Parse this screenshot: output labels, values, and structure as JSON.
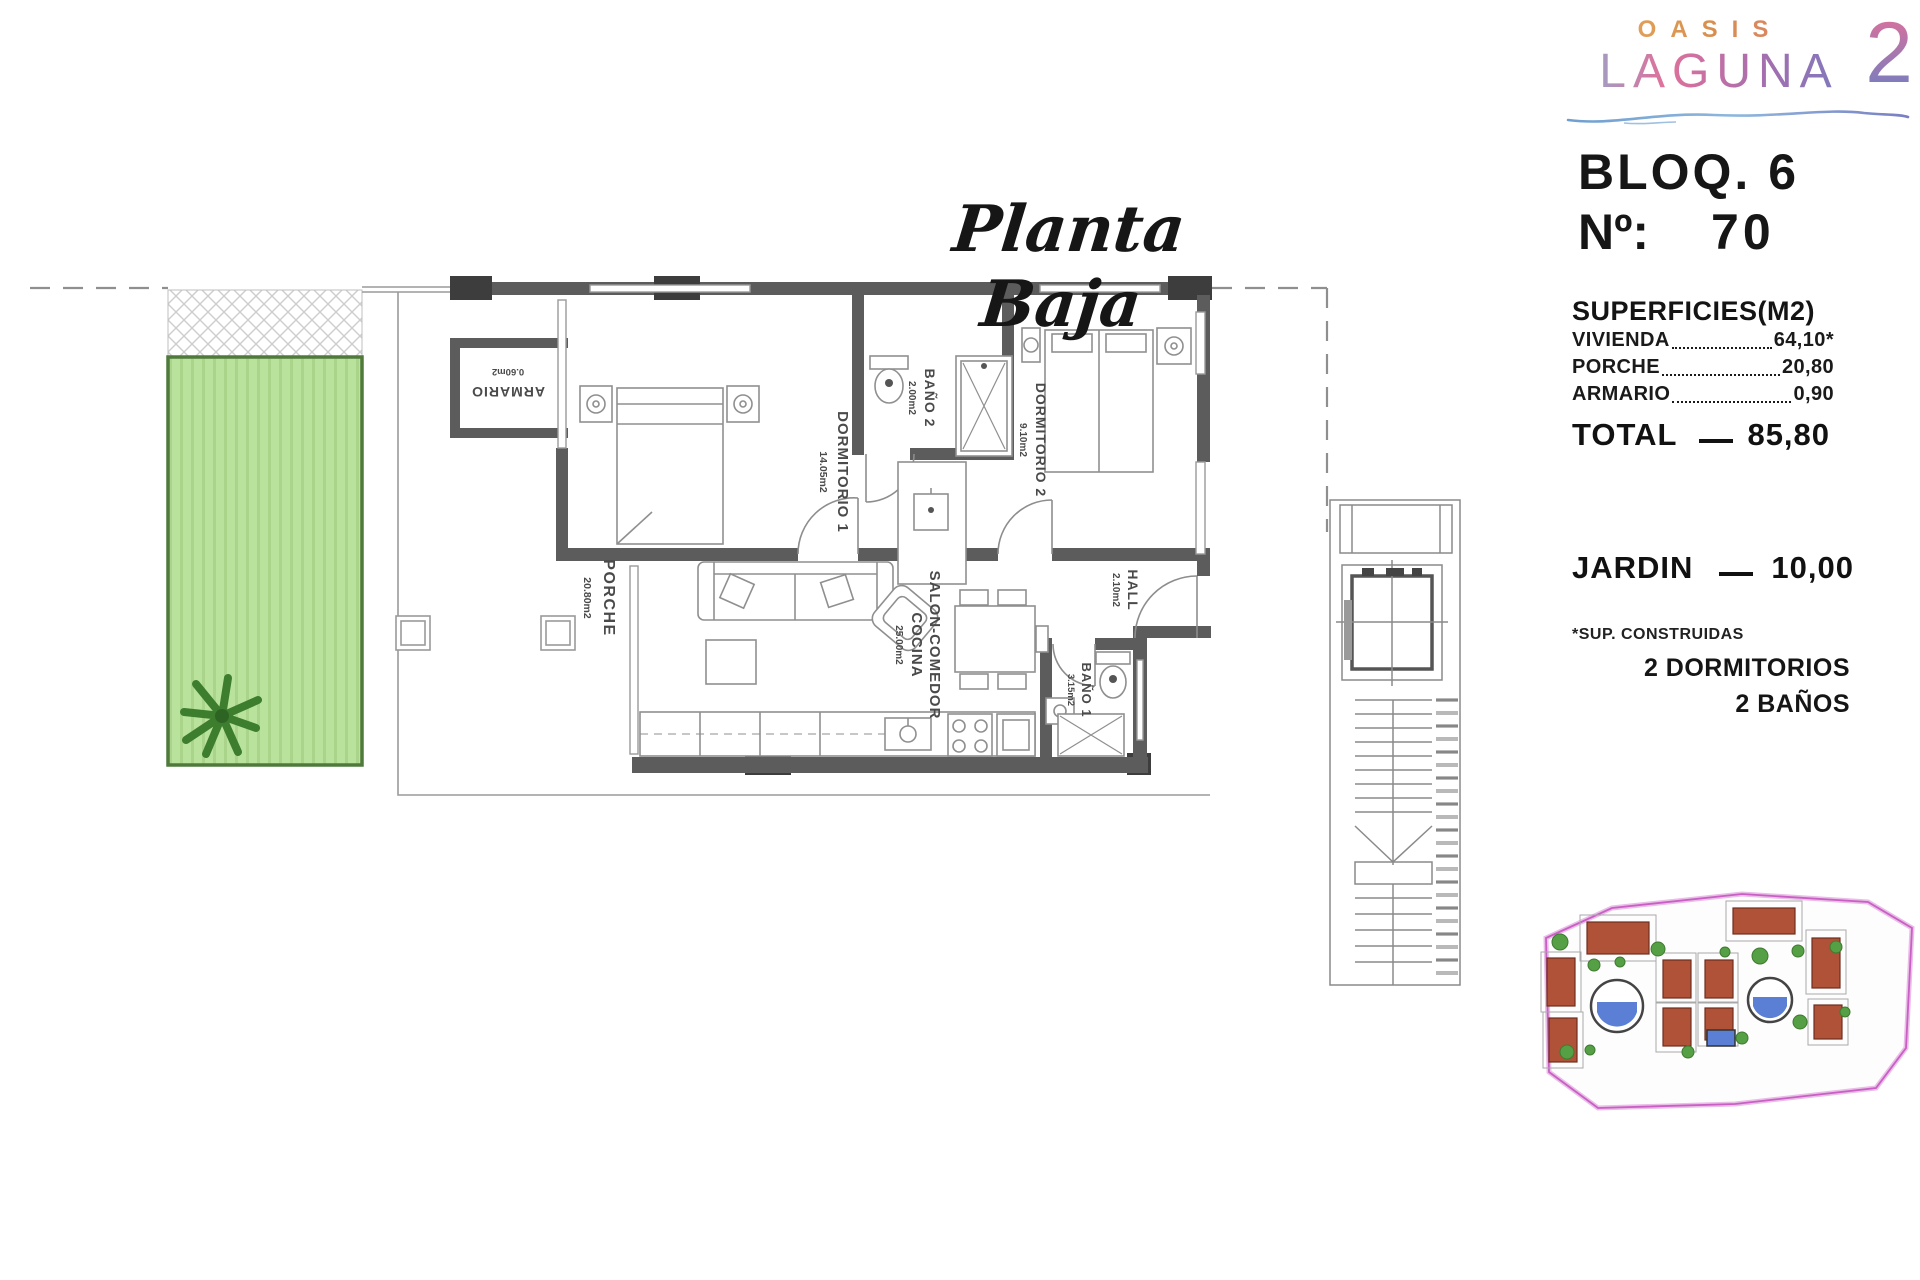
{
  "logo": {
    "top": "OASIS",
    "main": "LAGUNA",
    "number": "2"
  },
  "header": {
    "block": "BLOQ. 6",
    "unit_label": "Nº:",
    "unit_number": "70"
  },
  "plan_title": "Planta Baja",
  "surfaces": {
    "heading": "SUPERFICIES(M2)",
    "rows": [
      {
        "label": "VIVIENDA",
        "value": "64,10*"
      },
      {
        "label": "PORCHE",
        "value": "20,80"
      },
      {
        "label": "ARMARIO",
        "value": "0,90"
      }
    ],
    "total_label": "TOTAL",
    "total_value": "85,80",
    "garden_label": "JARDIN",
    "garden_value": "10,00",
    "footnote": "*SUP. CONSTRUIDAS",
    "features": [
      "2 DORMITORIOS",
      "2 BAÑOS"
    ]
  },
  "rooms": {
    "dormitorio1": {
      "name": "DORMITORIO 1",
      "area": "14.05m2"
    },
    "dormitorio2": {
      "name": "DORMITORIO 2",
      "area": "9.10m2"
    },
    "bano2": {
      "name": "BAÑO 2",
      "area": "2.00m2"
    },
    "bano1": {
      "name": "BAÑO 1",
      "area": "3.15m2"
    },
    "salon": {
      "name": "SALON-COMEDOR",
      "name2": "COCINA",
      "area": "25.00m2"
    },
    "hall": {
      "name": "HALL",
      "area": "2.10m2"
    },
    "porche": {
      "name": "PORCHE",
      "area": "20.80m2"
    },
    "armario": {
      "name": "ARMARIO",
      "area": "0.60m2"
    }
  },
  "colors": {
    "wall": "#5c5c5c",
    "garden_fill": "#b9e29c",
    "garden_border": "#4f7a3c",
    "palm": "#3c7d2e",
    "site_boundary": "#c95fc5",
    "site_building": "#b05238",
    "site_pool": "#5b7fd4",
    "site_tree": "#55a044"
  }
}
